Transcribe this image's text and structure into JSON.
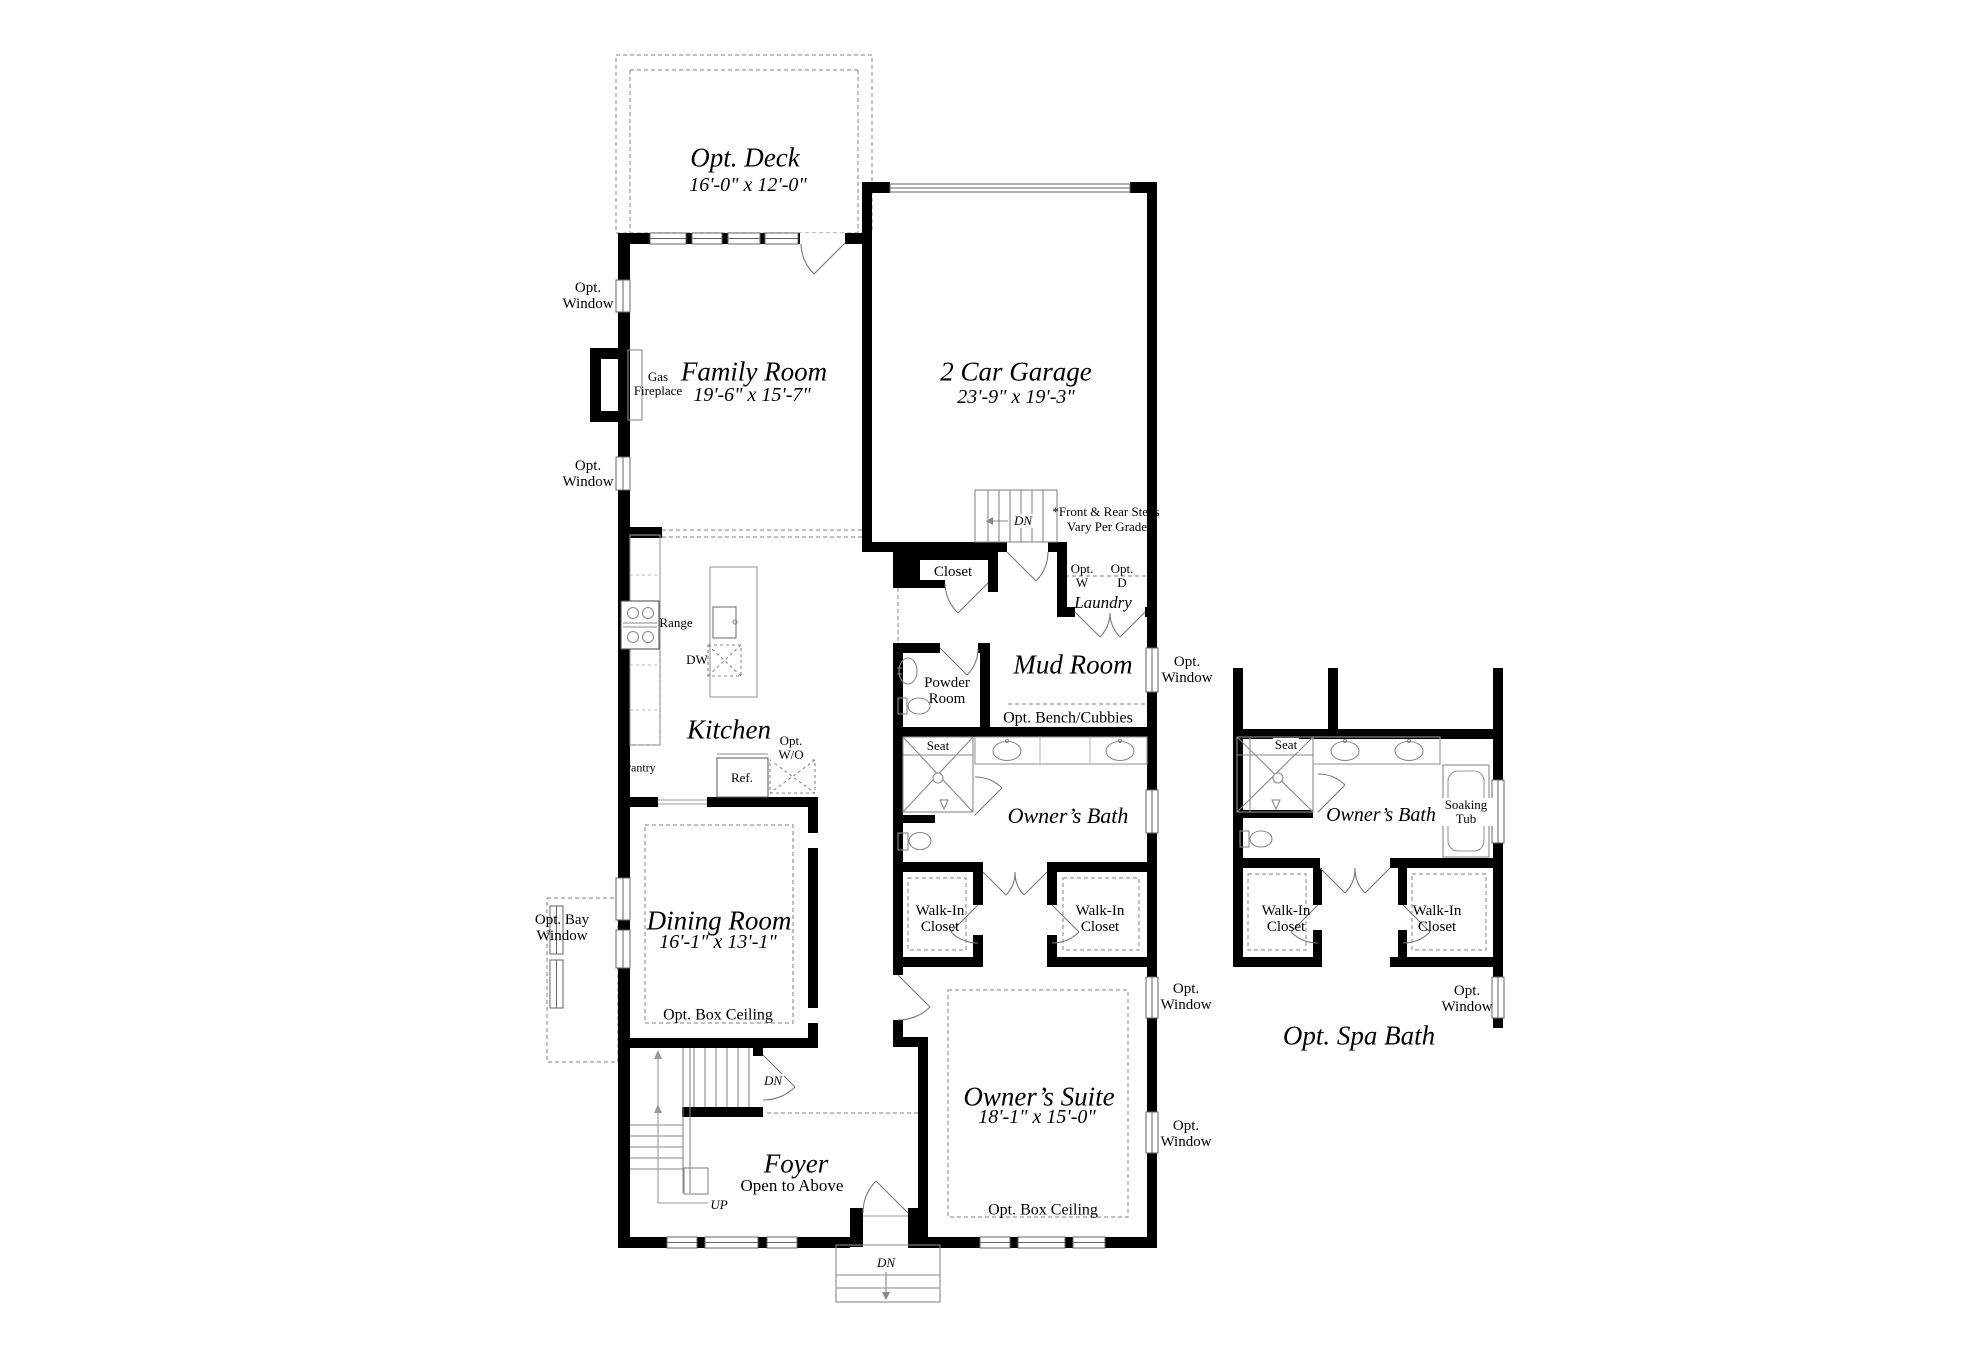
{
  "rooms": {
    "deck": {
      "name": "Opt. Deck",
      "dims": "16'-0\" x 12'-0\""
    },
    "family_room": {
      "name": "Family Room",
      "dims": "19'-6\" x 15'-7\""
    },
    "garage": {
      "name": "2 Car Garage",
      "dims": "23'-9\" x 19'-3\""
    },
    "kitchen": {
      "name": "Kitchen"
    },
    "mud_room": {
      "name": "Mud Room"
    },
    "laundry": {
      "name": "Laundry"
    },
    "closet": {
      "name": "Closet"
    },
    "powder_room": {
      "name": "Powder Room"
    },
    "owners_bath": {
      "name": "Owner’s Bath"
    },
    "walk_in_closet": {
      "name": "Walk-In Closet"
    },
    "dining_room": {
      "name": "Dining Room",
      "dims": "16'-1\" x 13'-1\"",
      "note": "Opt. Box Ceiling"
    },
    "owners_suite": {
      "name": "Owner’s Suite",
      "dims": "18'-1\" x 15'-0\"",
      "note": "Opt. Box Ceiling"
    },
    "foyer": {
      "name": "Foyer",
      "note": "Open to Above"
    },
    "spa_bath": {
      "title": "Opt. Spa Bath",
      "bath_name": "Owner’s Bath"
    }
  },
  "fixtures": {
    "range": "Range",
    "dishwasher": "DW",
    "refrigerator": "Ref.",
    "pantry": "Pantry",
    "gas_fireplace": "Gas Fireplace",
    "washer": "Opt. W",
    "dryer": "Opt. D",
    "wall_oven": "Opt. W/O",
    "seat": "Seat",
    "soaking_tub": "Soaking Tub"
  },
  "labels": {
    "opt_window": "Opt. Window",
    "opt_bay_window": "Opt. Bay Window",
    "opt_bench_cubbies": "Opt. Bench/Cubbies",
    "steps_note_1": "*Front & Rear Steps",
    "steps_note_2": "Vary Per Grade",
    "down": "DN",
    "up": "UP"
  }
}
